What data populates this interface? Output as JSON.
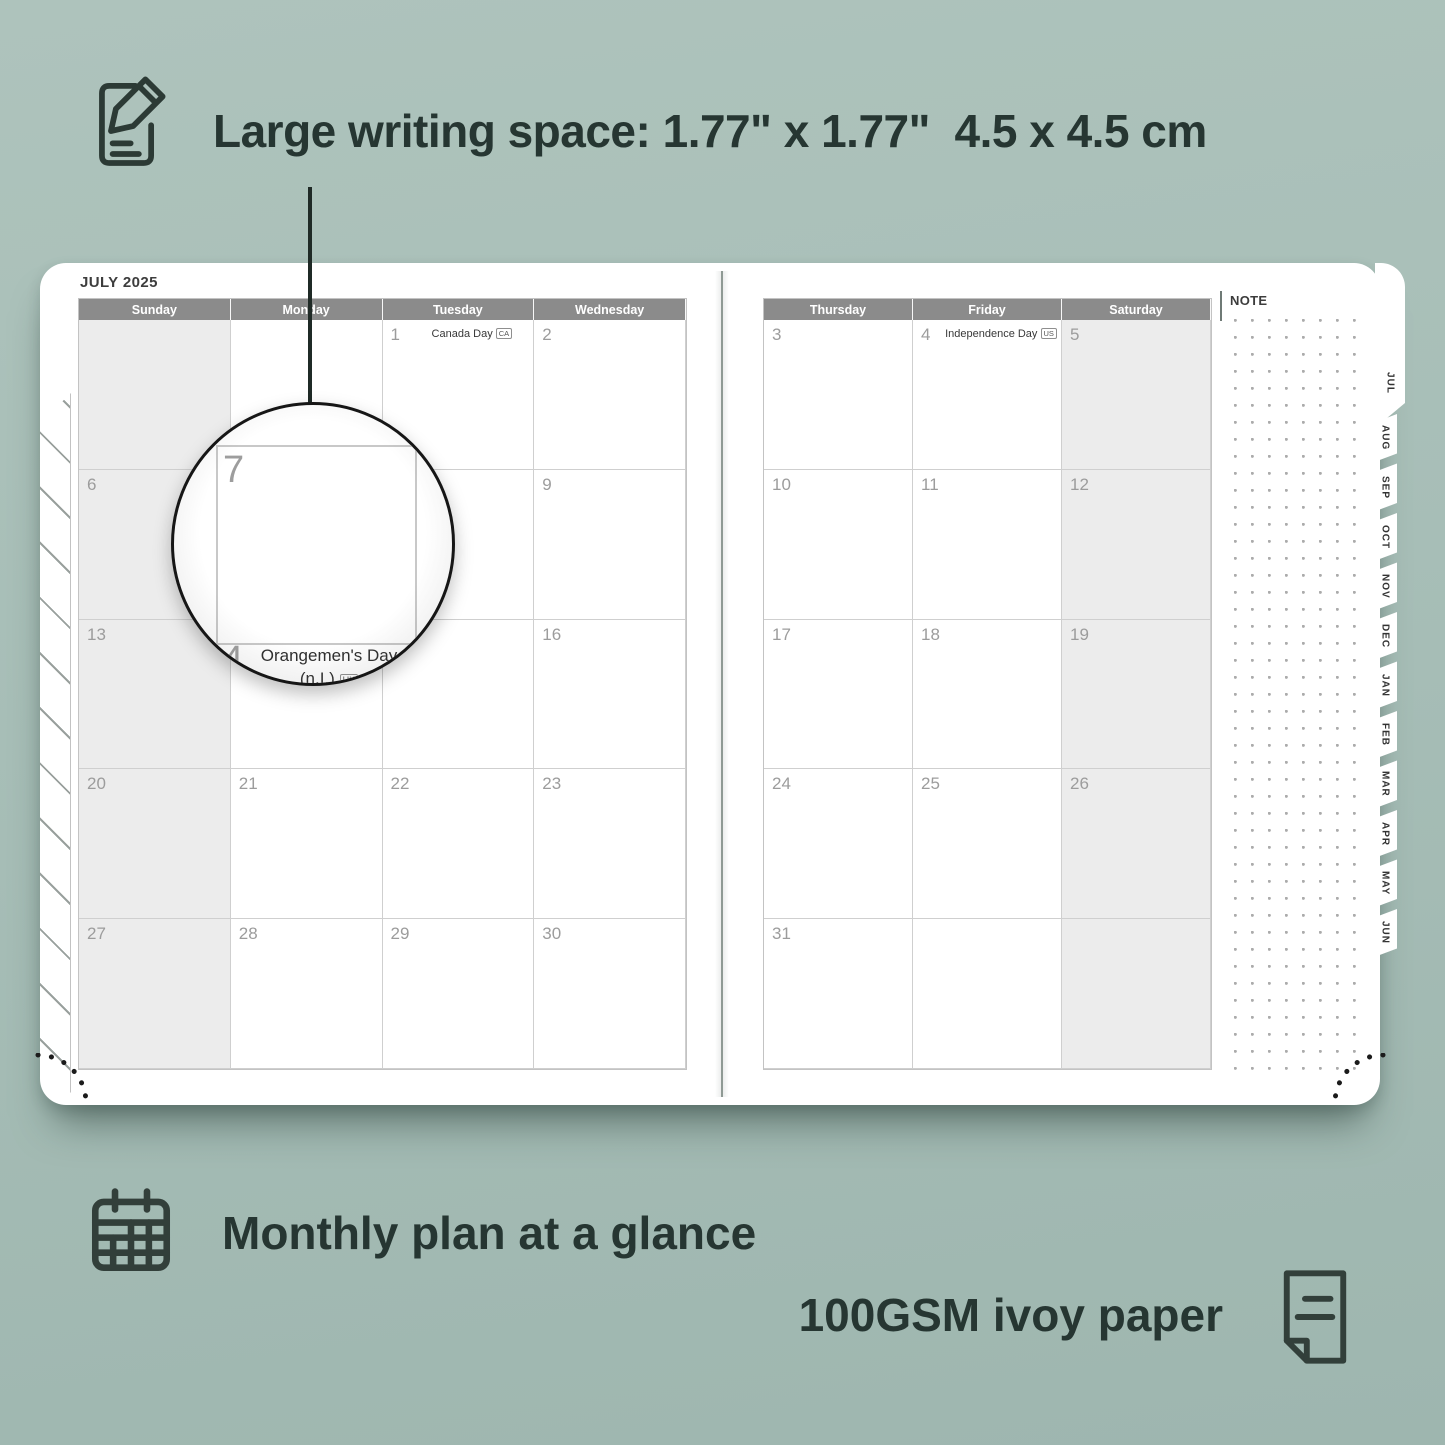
{
  "colors": {
    "background": "#a7beb7",
    "ink": "#263632",
    "header_bar": "#8b8b8b",
    "date_number": "#9c9c9c",
    "weekend_shade": "#ececec",
    "grid_line": "#cfcfcf",
    "page": "#ffffff"
  },
  "annotations": {
    "writing_space_label": "Large writing space: 1.77\" x 1.77\"  4.5 x 4.5 cm",
    "monthly_plan_label": "Monthly plan at a glance",
    "paper_label": "100GSM ivoy paper"
  },
  "planner": {
    "month_title": "JULY 2025",
    "note_label": "NOTE",
    "left_page": {
      "day_headers": [
        "Sunday",
        "Monday",
        "Tuesday",
        "Wednesday"
      ],
      "weekend_col": 0,
      "weeks": [
        [
          {
            "d": ""
          },
          {
            "d": ""
          },
          {
            "d": "1",
            "holiday": "Canada Day",
            "badge": "CA"
          },
          {
            "d": "2"
          }
        ],
        [
          {
            "d": "6"
          },
          {
            "d": "7"
          },
          {
            "d": "8"
          },
          {
            "d": "9"
          }
        ],
        [
          {
            "d": "13"
          },
          {
            "d": "14",
            "holiday": "Orangemen's Day (n.I.)",
            "badge": "UK"
          },
          {
            "d": "15"
          },
          {
            "d": "16"
          }
        ],
        [
          {
            "d": "20"
          },
          {
            "d": "21"
          },
          {
            "d": "22"
          },
          {
            "d": "23"
          }
        ],
        [
          {
            "d": "27"
          },
          {
            "d": "28"
          },
          {
            "d": "29"
          },
          {
            "d": "30"
          }
        ]
      ]
    },
    "right_page": {
      "day_headers": [
        "Thursday",
        "Friday",
        "Saturday"
      ],
      "weekend_col": 2,
      "weeks": [
        [
          {
            "d": "3"
          },
          {
            "d": "4",
            "holiday": "Independence Day",
            "badge": "US"
          },
          {
            "d": "5"
          }
        ],
        [
          {
            "d": "10"
          },
          {
            "d": "11"
          },
          {
            "d": "12"
          }
        ],
        [
          {
            "d": "17"
          },
          {
            "d": "18"
          },
          {
            "d": "19"
          }
        ],
        [
          {
            "d": "24"
          },
          {
            "d": "25"
          },
          {
            "d": "26"
          }
        ],
        [
          {
            "d": "31"
          },
          {
            "d": ""
          },
          {
            "d": ""
          }
        ]
      ]
    },
    "month_tabs": [
      "JUL",
      "AUG",
      "SEP",
      "OCT",
      "NOV",
      "DEC",
      "JAN",
      "FEB",
      "MAR",
      "APR",
      "MAY",
      "JUN"
    ],
    "active_tab": "JUL"
  },
  "magnifier": {
    "day": "7",
    "next_day": "14",
    "holiday_line1": "Orangemen's Day",
    "holiday_line2": "(n.I.)",
    "badge": "UK"
  }
}
